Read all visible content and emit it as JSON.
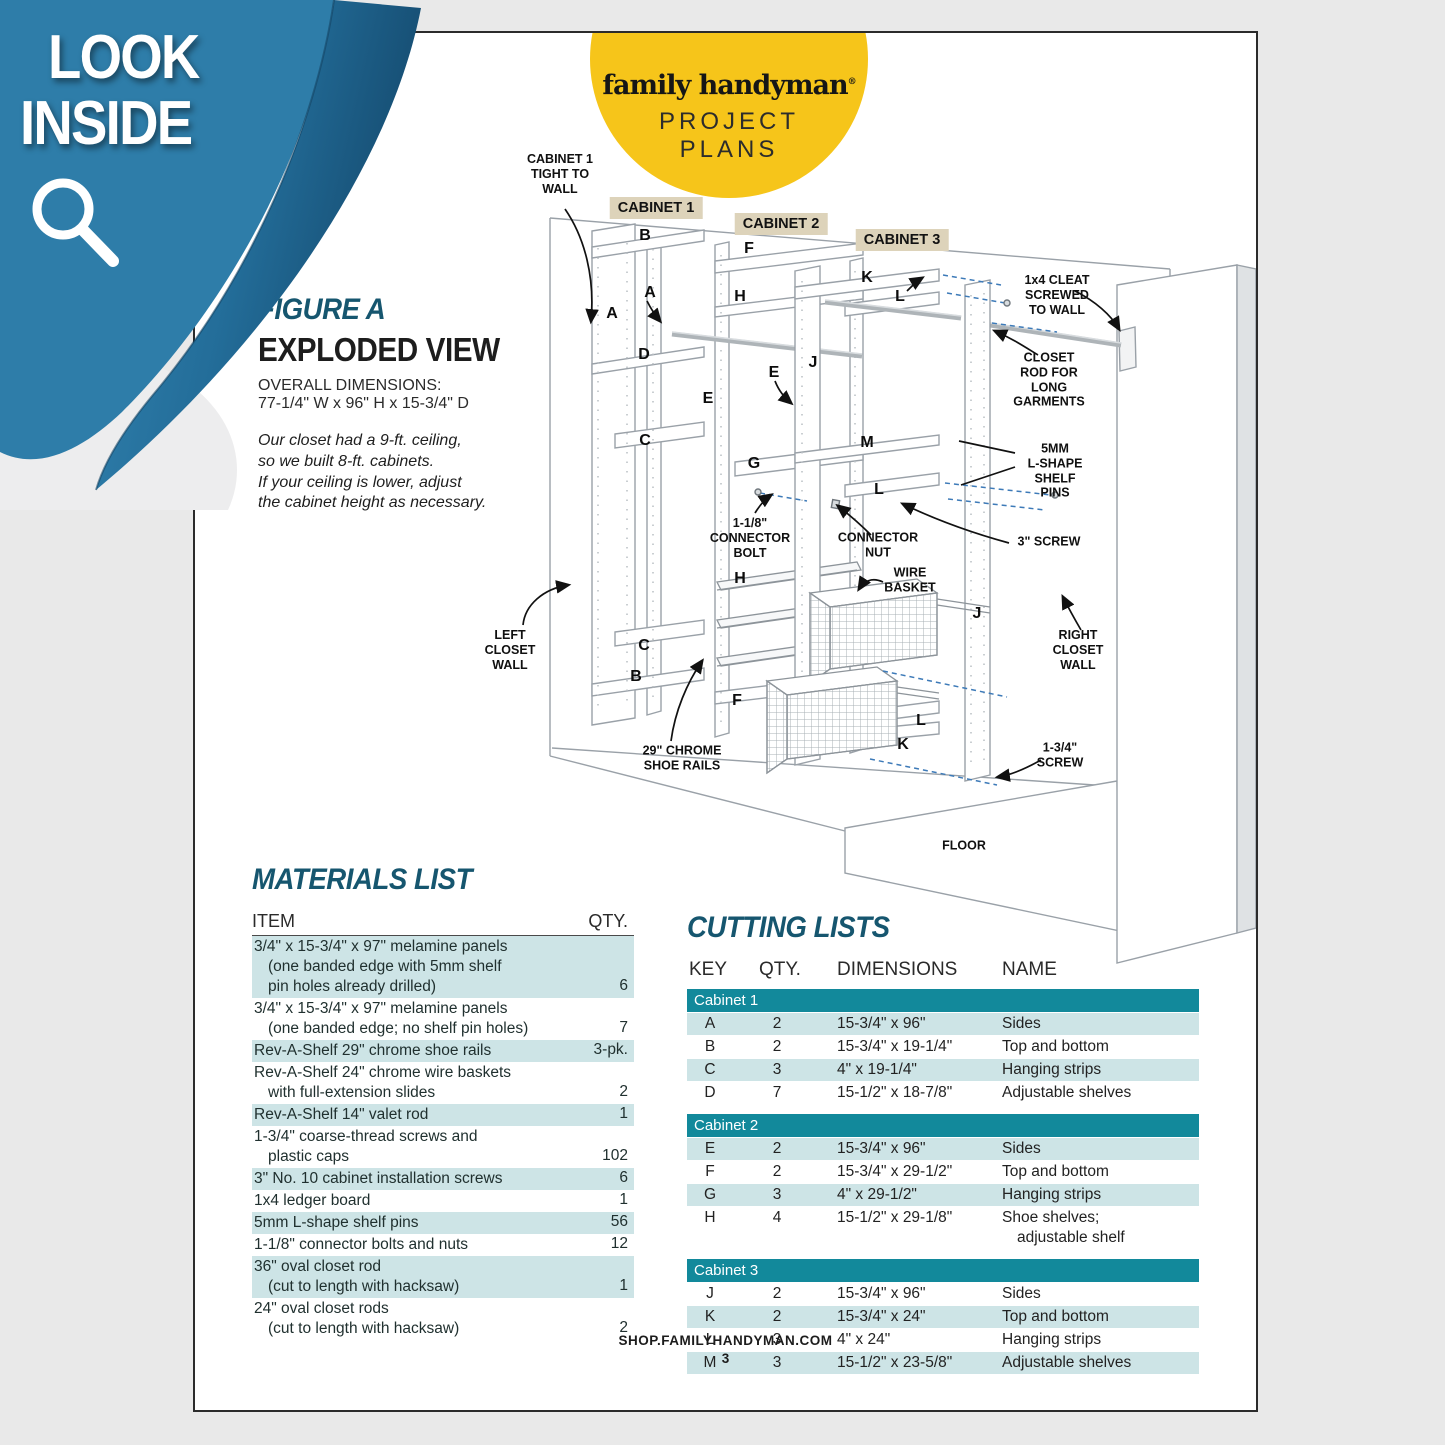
{
  "banner": {
    "line1": "LOOK",
    "line2": "INSIDE"
  },
  "logo": {
    "brand": "family handyman",
    "reg": "®",
    "line1": "PROJECT",
    "line2": "PLANS"
  },
  "figure": {
    "label": "FIGURE A",
    "title": "EXPLODED VIEW",
    "dims_heading": "OVERALL DIMENSIONS:",
    "dims": "77-1/4\" W x 96\" H x 15-3/4\" D",
    "note_lines": [
      "Our closet had a 9-ft. ceiling,",
      "so we built 8-ft. cabinets.",
      "If your ceiling is lower, adjust",
      "the cabinet height as necessary."
    ]
  },
  "diagram": {
    "cabinet_tags": [
      {
        "text": "CABINET 1",
        "x": 461,
        "y": 175
      },
      {
        "text": "CABINET 2",
        "x": 586,
        "y": 191
      },
      {
        "text": "CABINET 3",
        "x": 707,
        "y": 207
      }
    ],
    "part_letters": [
      {
        "t": "B",
        "x": 450,
        "y": 203
      },
      {
        "t": "A",
        "x": 417,
        "y": 281
      },
      {
        "t": "A",
        "x": 455,
        "y": 260
      },
      {
        "t": "D",
        "x": 449,
        "y": 322
      },
      {
        "t": "C",
        "x": 450,
        "y": 408
      },
      {
        "t": "C",
        "x": 449,
        "y": 613
      },
      {
        "t": "B",
        "x": 441,
        "y": 644
      },
      {
        "t": "F",
        "x": 554,
        "y": 216
      },
      {
        "t": "H",
        "x": 545,
        "y": 264
      },
      {
        "t": "E",
        "x": 513,
        "y": 366
      },
      {
        "t": "E",
        "x": 579,
        "y": 340
      },
      {
        "t": "G",
        "x": 559,
        "y": 431
      },
      {
        "t": "H",
        "x": 545,
        "y": 546
      },
      {
        "t": "F",
        "x": 542,
        "y": 668
      },
      {
        "t": "K",
        "x": 672,
        "y": 245
      },
      {
        "t": "L",
        "x": 705,
        "y": 264
      },
      {
        "t": "J",
        "x": 618,
        "y": 330
      },
      {
        "t": "M",
        "x": 672,
        "y": 410
      },
      {
        "t": "L",
        "x": 684,
        "y": 457
      },
      {
        "t": "J",
        "x": 782,
        "y": 581
      },
      {
        "t": "L",
        "x": 726,
        "y": 688
      },
      {
        "t": "K",
        "x": 708,
        "y": 712
      }
    ],
    "callouts": [
      {
        "lines": [
          "CABINET 1",
          "TIGHT TO",
          "WALL"
        ],
        "x": 365,
        "y": 141
      },
      {
        "lines": [
          "1x4 CLEAT",
          "SCREWED",
          "TO WALL"
        ],
        "x": 862,
        "y": 262
      },
      {
        "lines": [
          "CLOSET",
          "ROD FOR",
          "LONG",
          "GARMENTS"
        ],
        "x": 854,
        "y": 347
      },
      {
        "lines": [
          "5MM",
          "L-SHAPE",
          "SHELF",
          "PINS"
        ],
        "x": 860,
        "y": 438
      },
      {
        "lines": [
          "3\" SCREW"
        ],
        "x": 854,
        "y": 509
      },
      {
        "lines": [
          "1-1/8\"",
          "CONNECTOR",
          "BOLT"
        ],
        "x": 555,
        "y": 505
      },
      {
        "lines": [
          "CONNECTOR",
          "NUT"
        ],
        "x": 683,
        "y": 512
      },
      {
        "lines": [
          "WIRE",
          "BASKET"
        ],
        "x": 715,
        "y": 547
      },
      {
        "lines": [
          "LEFT",
          "CLOSET",
          "WALL"
        ],
        "x": 315,
        "y": 617
      },
      {
        "lines": [
          "RIGHT",
          "CLOSET",
          "WALL"
        ],
        "x": 883,
        "y": 617
      },
      {
        "lines": [
          "29\" CHROME",
          "SHOE RAILS"
        ],
        "x": 487,
        "y": 725
      },
      {
        "lines": [
          "1-3/4\"",
          "SCREW"
        ],
        "x": 865,
        "y": 722
      }
    ],
    "floor_label": {
      "text": "FLOOR",
      "x": 769,
      "y": 813
    }
  },
  "materials": {
    "title": "MATERIALS LIST",
    "col_item": "ITEM",
    "col_qty": "QTY.",
    "rows": [
      {
        "lines": [
          "3/4\" x 15-3/4\" x 97\" melamine panels",
          "(one banded edge with 5mm shelf",
          "pin holes already drilled)"
        ],
        "qty": "6",
        "hl": true
      },
      {
        "lines": [
          "3/4\" x 15-3/4\" x 97\" melamine panels",
          "(one banded edge; no shelf pin holes)"
        ],
        "qty": "7",
        "hl": false
      },
      {
        "lines": [
          "Rev-A-Shelf 29\" chrome shoe rails"
        ],
        "qty": "3-pk.",
        "hl": true
      },
      {
        "lines": [
          "Rev-A-Shelf 24\" chrome wire baskets",
          "with full-extension slides"
        ],
        "qty": "2",
        "hl": false
      },
      {
        "lines": [
          "Rev-A-Shelf 14\" valet rod"
        ],
        "qty": "1",
        "hl": true
      },
      {
        "lines": [
          "1-3/4\" coarse-thread screws and",
          "plastic caps"
        ],
        "qty": "102",
        "hl": false
      },
      {
        "lines": [
          "3\" No. 10 cabinet installation screws"
        ],
        "qty": "6",
        "hl": true
      },
      {
        "lines": [
          "1x4 ledger board"
        ],
        "qty": "1",
        "hl": false
      },
      {
        "lines": [
          "5mm L-shape shelf pins"
        ],
        "qty": "56",
        "hl": true
      },
      {
        "lines": [
          "1-1/8\" connector bolts and nuts"
        ],
        "qty": "12",
        "hl": false
      },
      {
        "lines": [
          "36\" oval closet rod",
          "(cut to length with hacksaw)"
        ],
        "qty": "1",
        "hl": true
      },
      {
        "lines": [
          "24\" oval closet rods",
          "(cut to length with hacksaw)"
        ],
        "qty": "2",
        "hl": false
      }
    ]
  },
  "cutting": {
    "title": "CUTTING LISTS",
    "headers": [
      "KEY",
      "QTY.",
      "DIMENSIONS",
      "NAME"
    ],
    "sections": [
      {
        "name": "Cabinet 1",
        "rows": [
          {
            "key": "A",
            "qty": "2",
            "dim": "15-3/4\" x 96\"",
            "name": [
              "Sides"
            ],
            "hl": true
          },
          {
            "key": "B",
            "qty": "2",
            "dim": "15-3/4\" x 19-1/4\"",
            "name": [
              "Top and bottom"
            ],
            "hl": false
          },
          {
            "key": "C",
            "qty": "3",
            "dim": "4\" x 19-1/4\"",
            "name": [
              "Hanging strips"
            ],
            "hl": true
          },
          {
            "key": "D",
            "qty": "7",
            "dim": "15-1/2\" x 18-7/8\"",
            "name": [
              "Adjustable shelves"
            ],
            "hl": false
          }
        ]
      },
      {
        "name": "Cabinet 2",
        "rows": [
          {
            "key": "E",
            "qty": "2",
            "dim": "15-3/4\" x 96\"",
            "name": [
              "Sides"
            ],
            "hl": true
          },
          {
            "key": "F",
            "qty": "2",
            "dim": "15-3/4\" x 29-1/2\"",
            "name": [
              "Top and bottom"
            ],
            "hl": false
          },
          {
            "key": "G",
            "qty": "3",
            "dim": "4\" x 29-1/2\"",
            "name": [
              "Hanging strips"
            ],
            "hl": true
          },
          {
            "key": "H",
            "qty": "4",
            "dim": "15-1/2\" x 29-1/8\"",
            "name": [
              "Shoe shelves;",
              "adjustable shelf"
            ],
            "hl": false
          }
        ]
      },
      {
        "name": "Cabinet 3",
        "rows": [
          {
            "key": "J",
            "qty": "2",
            "dim": "15-3/4\" x 96\"",
            "name": [
              "Sides"
            ],
            "hl": false
          },
          {
            "key": "K",
            "qty": "2",
            "dim": "15-3/4\" x 24\"",
            "name": [
              "Top and bottom"
            ],
            "hl": true
          },
          {
            "key": "L",
            "qty": "3",
            "dim": "4\" x 24\"",
            "name": [
              "Hanging strips"
            ],
            "hl": false
          },
          {
            "key": "M",
            "qty": "3",
            "dim": "15-1/2\" x 23-5/8\"",
            "name": [
              "Adjustable shelves"
            ],
            "hl": true
          }
        ]
      }
    ]
  },
  "footer": {
    "site": "SHOP.FAMILYHANDYMAN.COM",
    "page": "3"
  }
}
